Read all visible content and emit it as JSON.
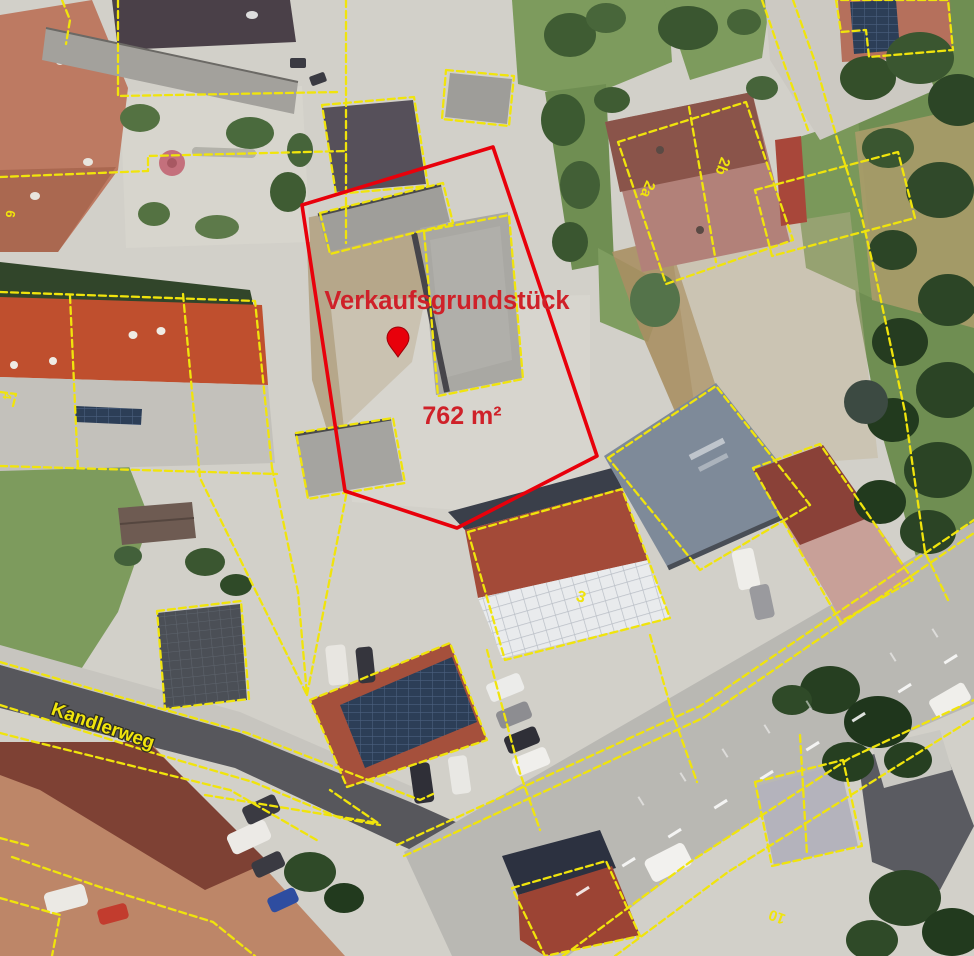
{
  "map": {
    "type": "aerial-cadastral-view",
    "sale_parcel": {
      "label": "Verkaufsgrundstück",
      "area_label": "762 m²",
      "outline_color": "#e8000b",
      "label_color": "#cf2129",
      "pin_color": "#e8000b"
    },
    "cadastral": {
      "line_color": "#f0e40c",
      "street_label": {
        "text": "Kandlerweg",
        "color": "#f0e40c"
      },
      "parcel_numbers": [
        {
          "text": "6"
        },
        {
          "text": "4"
        },
        {
          "text": "2a"
        },
        {
          "text": "2b"
        },
        {
          "text": "3"
        },
        {
          "text": "10"
        }
      ]
    }
  }
}
